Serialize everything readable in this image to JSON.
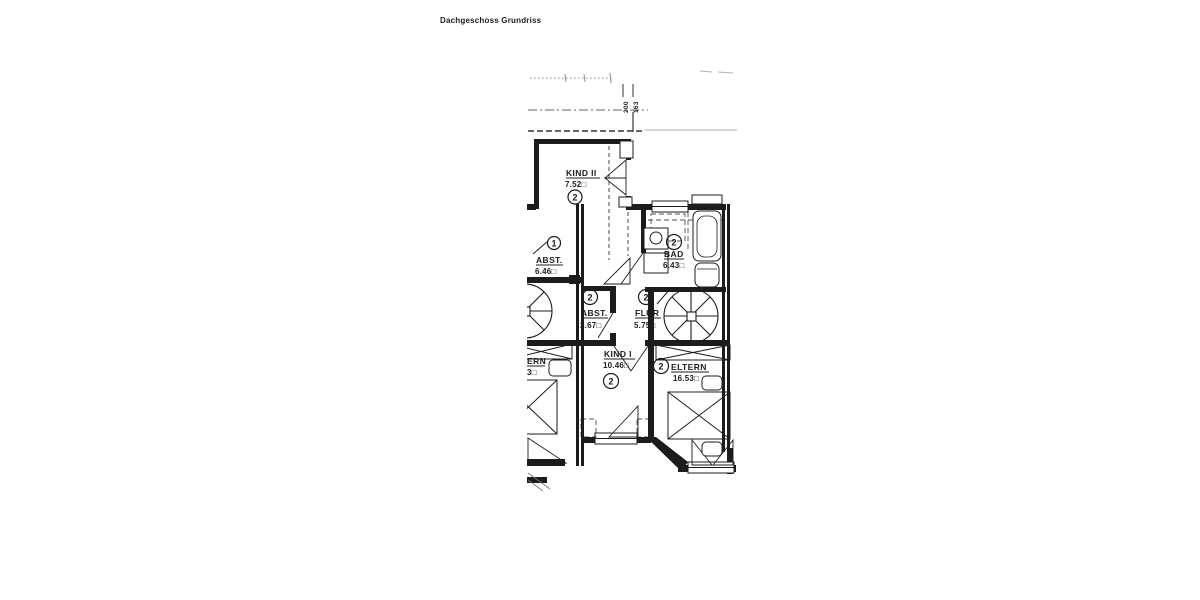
{
  "title": "Dachgeschoss Grundriss",
  "dim_marks": [
    "200",
    "163"
  ],
  "rooms": [
    {
      "unit": "2",
      "name": "KIND II",
      "area": "7.52□"
    },
    {
      "unit": "1",
      "name": "ABST.",
      "area": "6.46□"
    },
    {
      "unit": "2",
      "name": "BAD",
      "area": "6.43□"
    },
    {
      "unit": "2",
      "name": "ABST.",
      "area": "2.67□"
    },
    {
      "unit": "2",
      "name": "FLUR",
      "area": "5.75□"
    },
    {
      "unit": "2",
      "name": "KIND I",
      "area": "10.46□"
    },
    {
      "unit": "2",
      "name": "ELTERN",
      "area": "16.53□"
    },
    {
      "unit": "",
      "name": "ERN",
      "area": "3□"
    }
  ],
  "colors": {
    "ink": "#1c1c1c",
    "faint": "#999999",
    "paper": "#ffffff"
  }
}
